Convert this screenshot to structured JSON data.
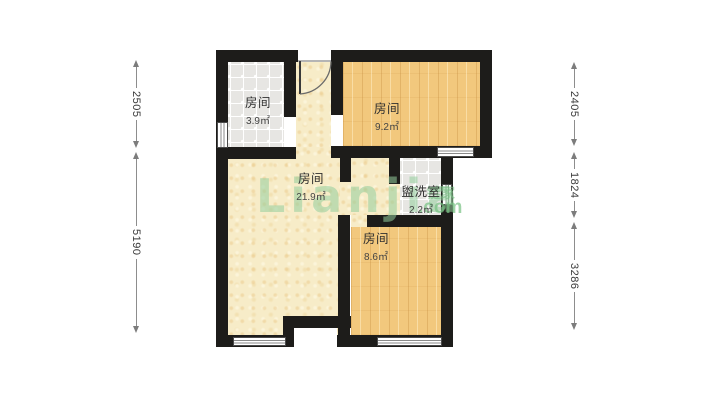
{
  "fp": {
    "watermark": {
      "brand": "Lianjia",
      "cn": "链家",
      "suffix": ".com"
    },
    "rooms": [
      {
        "label": "房间",
        "area": "3.9㎡"
      },
      {
        "label": "房间",
        "area": "9.2㎡"
      },
      {
        "label": "房间",
        "area": "21.9㎡"
      },
      {
        "label": "盥洗室",
        "area": "2.2㎡"
      },
      {
        "label": "房间",
        "area": "8.6㎡"
      }
    ],
    "dims": {
      "left": [
        {
          "value": "2505"
        },
        {
          "value": "5190"
        }
      ],
      "right": [
        {
          "value": "2405"
        },
        {
          "value": "1824"
        },
        {
          "value": "3286"
        }
      ]
    },
    "colors": {
      "wall": "#1d1c1a",
      "wood_floor": "#f2c87d",
      "tile_floor": "#e7e6e3",
      "main_floor": "#f7ecc8",
      "watermark_green": "#94cd9c"
    }
  }
}
